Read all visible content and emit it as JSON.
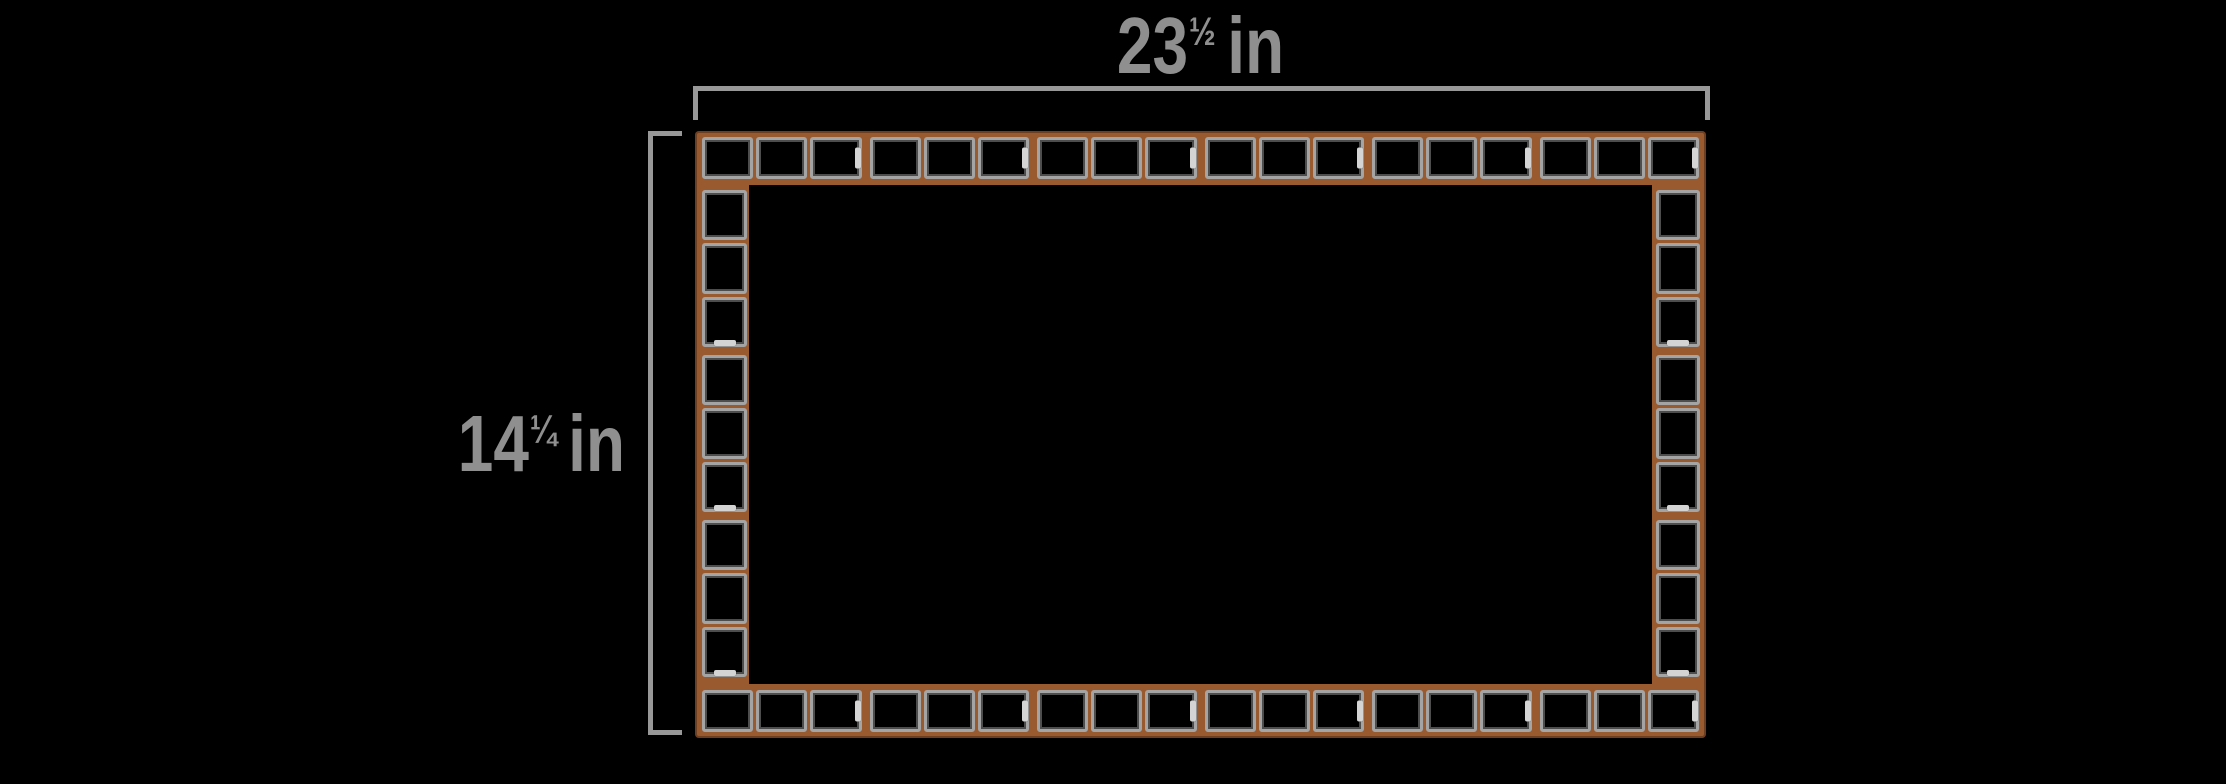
{
  "figure": {
    "type": "tiled-frame-dimension-diagram",
    "width_label": {
      "whole": "23",
      "fraction": "½",
      "unit": "in",
      "text": "23½ in"
    },
    "height_label": {
      "whole": "14",
      "fraction": "¼",
      "unit": "in",
      "text": "14¼ in"
    },
    "tile_strips": {
      "top": {
        "orientation": "row",
        "groups": 6,
        "tiles_per_group": 3
      },
      "bottom": {
        "orientation": "row",
        "groups": 6,
        "tiles_per_group": 3
      },
      "left": {
        "orientation": "column",
        "groups": 3,
        "tiles_per_group": 3
      },
      "right": {
        "orientation": "column",
        "groups": 3,
        "tiles_per_group": 3
      }
    },
    "colors": {
      "background": "#000000",
      "frame_backing": "#9a5a30",
      "tile_border": "#a4a4a4",
      "tile_fill": "#000000",
      "spacer_tab": "#d4d4d4",
      "dimension_line": "#989898",
      "dimension_text": "#8f8f8f"
    }
  }
}
